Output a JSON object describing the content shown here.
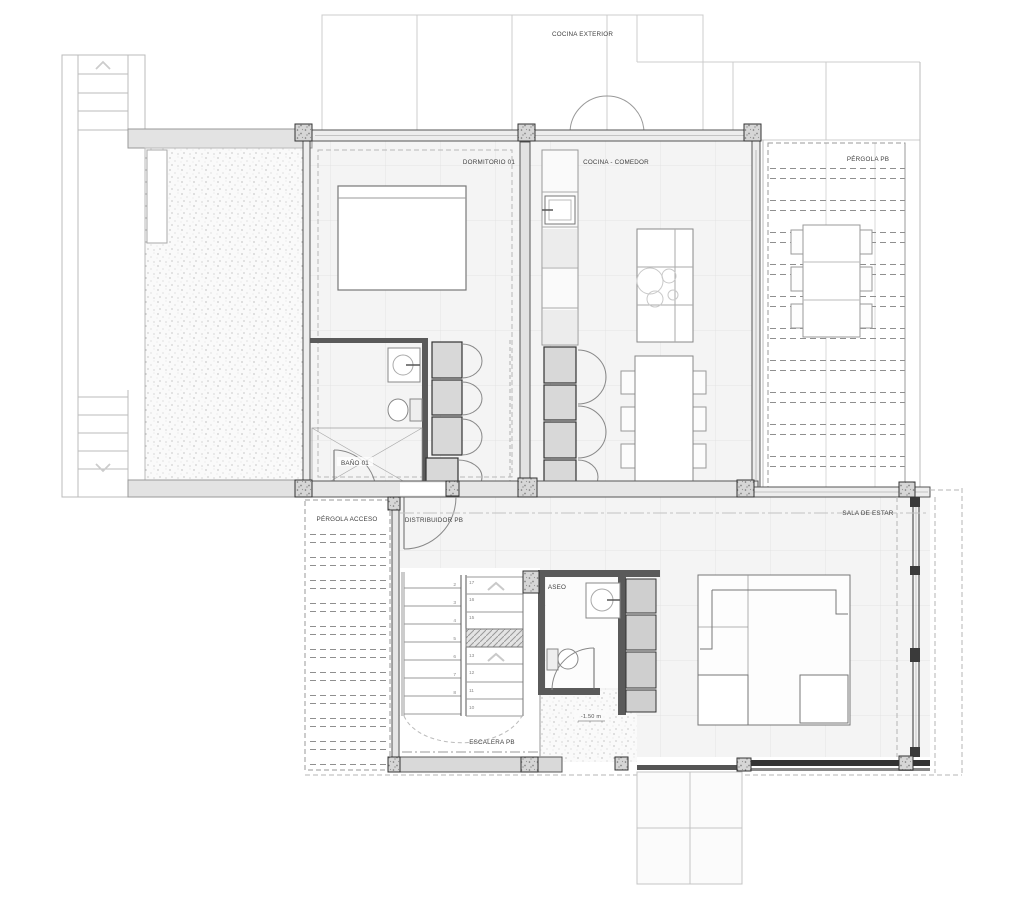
{
  "labels": {
    "cocina_exterior": "COCINA EXTERIOR",
    "dormitorio_01": "DORMITORIO 01",
    "cocina_comedor": "COCINA - COMEDOR",
    "pergola_pb": "PÉRGOLA PB",
    "bano_01": "BAÑO 01",
    "pergola_acceso": "PÉRGOLA ACCESO",
    "distribuidor_pb": "DISTRIBUIDOR PB",
    "sala_de_estar": "SALA DE ESTAR",
    "aseo": "ASEO",
    "escalera_pb": "ESCALERA PB",
    "nivel_escalera": "-1.50 m"
  },
  "stairs": {
    "left_flight_numbers": [
      "2",
      "3",
      "4",
      "5",
      "6",
      "7",
      "8"
    ],
    "right_flight_numbers": [
      "17",
      "16",
      "15",
      "13",
      "12",
      "11",
      "10"
    ]
  },
  "colors": {
    "background": "#ffffff",
    "line_light": "#cccccc",
    "line_dark": "#4a4a4a",
    "fill_floor": "#f4f4f4",
    "fill_cabinet": "#d8d8d8",
    "fill_wall": "#e8e8e8"
  }
}
